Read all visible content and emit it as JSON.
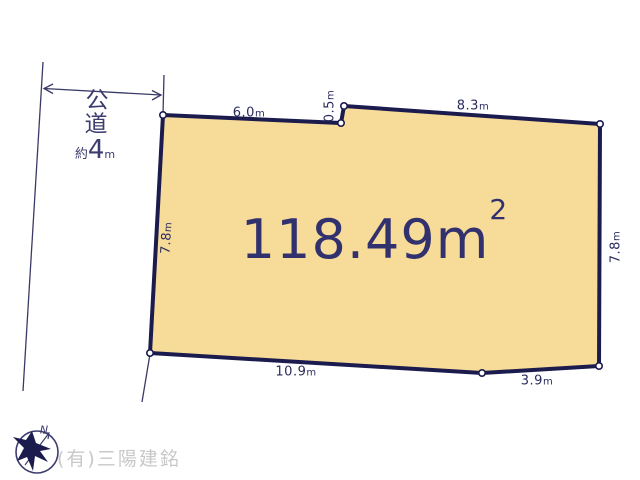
{
  "road": {
    "name_chars": [
      "公",
      "道"
    ],
    "width_label": {
      "prefix": "約",
      "value": "4",
      "unit": "m"
    }
  },
  "parcel": {
    "area": {
      "value": "118.49",
      "unit": "m",
      "superscript": "2"
    },
    "dimensions": {
      "top_left": {
        "value": "6.0",
        "unit": "m"
      },
      "notch": {
        "value": "0.5",
        "unit": "m"
      },
      "top_right": {
        "value": "8.3",
        "unit": "m"
      },
      "left_side": {
        "value": "7.8",
        "unit": "m"
      },
      "right_side": {
        "value": "7.8",
        "unit": "m"
      },
      "bottom_left": {
        "value": "10.9",
        "unit": "m"
      },
      "bottom_right": {
        "value": "3.9",
        "unit": "m"
      }
    }
  },
  "compass": {
    "north_label": "N"
  },
  "footer": {
    "company": "(有)三陽建銘"
  },
  "colors": {
    "parcel_fill": "#f7db99",
    "outline": "#1b1b4e",
    "dim_text": "#2b2b5e",
    "area_text": "#31316e",
    "road_text": "#3c3c6e",
    "thin_line": "#3a3a66",
    "watermark": "#c8c8c8"
  }
}
